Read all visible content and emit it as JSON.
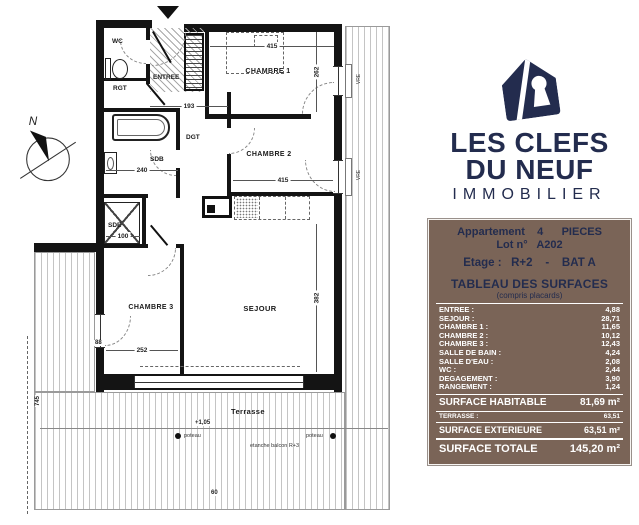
{
  "colors": {
    "navy": "#232c4e",
    "brown": "#7a6457"
  },
  "logo": {
    "line1": "LES CLEFS",
    "line2": "DU NEUF",
    "line3": "IMMOBILIER"
  },
  "info": {
    "line1": "Appartement    4      PIECES",
    "line2": "Lot n°   A202",
    "line3": "Etage :   R+2    -    BAT A",
    "table_title": "TABLEAU DES SURFACES",
    "table_subtitle": "(compris placards)"
  },
  "surfaces": {
    "rows": [
      {
        "label": "ENTREE :",
        "value": "4,88"
      },
      {
        "label": "SEJOUR :",
        "value": "28,71"
      },
      {
        "label": "CHAMBRE 1 :",
        "value": "11,65"
      },
      {
        "label": "CHAMBRE 2 :",
        "value": "10,12"
      },
      {
        "label": "CHAMBRE 3 :",
        "value": "12,43"
      },
      {
        "label": "SALLE DE BAIN :",
        "value": "4,24"
      },
      {
        "label": "SALLE D'EAU :",
        "value": "2,08"
      },
      {
        "label": "WC :",
        "value": "2,44"
      },
      {
        "label": "DEGAGEMENT :",
        "value": "3,90"
      },
      {
        "label": "RANGEMENT :",
        "value": "1,24"
      }
    ],
    "habitable": {
      "label": "SURFACE HABITABLE",
      "value": "81,69 m²"
    },
    "terrasse": {
      "label": "TERRASSE :",
      "value": "63,51"
    },
    "exterieure": {
      "label": "SURFACE EXTERIEURE",
      "value": "63,51 m²"
    },
    "totale": {
      "label": "SURFACE TOTALE",
      "value": "145,20 m²"
    }
  },
  "plan": {
    "rooms": {
      "wc": "WC",
      "entree": "ENTREE",
      "rgt": "RGT",
      "dgt": "DGT",
      "sdb": "SDB",
      "sde": "SDE",
      "chambre1": "CHAMBRE 1",
      "chambre2": "CHAMBRE 2",
      "chambre3": "CHAMBRE 3",
      "sejour": "SEJOUR",
      "terrasse": "Terrasse"
    },
    "dims": {
      "d415a": "415",
      "d415b": "415",
      "d262": "262",
      "d193": "193",
      "d240": "240",
      "d382": "382",
      "d252": "252",
      "d100": "100",
      "d88": "88",
      "d60": "60",
      "d745": "745",
      "level": "+1,05"
    },
    "annotations": {
      "north": "N",
      "poteau": "poteau",
      "etanche": "etanche balcon R+3",
      "vre": "VRE"
    }
  }
}
